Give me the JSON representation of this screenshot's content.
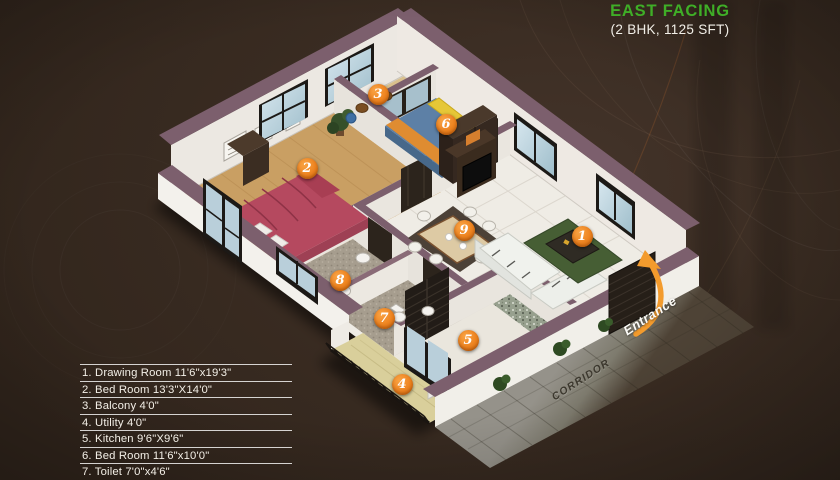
{
  "header": {
    "title": "EAST FACING",
    "subtitle": "(2 BHK, 1125 SFT)"
  },
  "legend": {
    "items": [
      "1. Drawing Room 11'6\"x19'3\"",
      "2. Bed Room 13'3\"X14'0\"",
      "3. Balcony 4'0\"",
      "4. Utility 4'0\"",
      "5. Kitchen 9'6\"X9'6\"",
      "6. Bed Room 11'6\"x10'0\"",
      "7. Toilet 7'0\"x4'6\""
    ]
  },
  "plan": {
    "corridor_label": "CORRIDOR",
    "entrance_label": "Entrance",
    "markers": [
      "1",
      "2",
      "3",
      "4",
      "5",
      "6",
      "7",
      "8",
      "9"
    ]
  },
  "colors": {
    "accent_green": "#3fae27",
    "marker_orange": "#ee8420",
    "wall_trim": "#7c5f6d"
  }
}
